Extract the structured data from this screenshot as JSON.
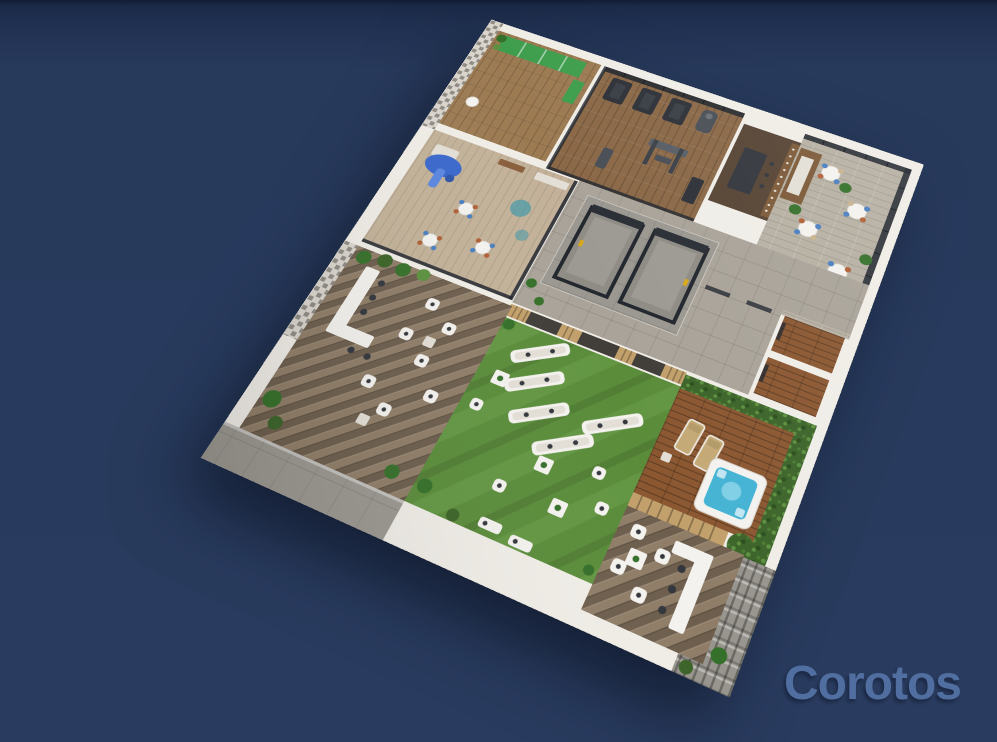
{
  "watermark": {
    "text": "Corotos",
    "color": "#5371a3"
  },
  "background": {
    "top": "#111d35",
    "upper": "#1b2a47",
    "main": "#283a5c"
  },
  "palette": {
    "wall": "#f0ede7",
    "wall_shadow": "#d7d2c9",
    "yoga_wood": "#9c7b53",
    "gym_wood": "#8a6847",
    "dining_floor": "#b7b0a3",
    "kids_floor": "#c3b299",
    "lobby_tile": "#a9a399",
    "concrete": "#9b9891",
    "steel": "#2a2e35",
    "glass": "#20252e",
    "wine_bar_floor": "#564434",
    "shelf_wood": "#7c5a38",
    "herringbone_a": "#8f7d67",
    "herringbone_b": "#6d5e4d",
    "lawn": "#5a8c3a",
    "lawn_light": "#6fa24d",
    "deck_wood": "#8a5731",
    "slat_wood": "#c2a06b",
    "hedge": "#3c6429",
    "hedge_light": "#5d9140",
    "plant": "#35702a",
    "jacuzzi_water": "#45b3d4",
    "jacuzzi_light": "#8ad4e8",
    "gravel": "#98958e",
    "mat_green": "#3f9e4e",
    "chair_blue": "#4a7fc1",
    "chair_rust": "#b06036",
    "rug_teal": "#4b9aa8",
    "slide_blue": "#3a68cc",
    "furniture_white": "#f4f2ee",
    "lounger_tan": "#c4a976"
  }
}
